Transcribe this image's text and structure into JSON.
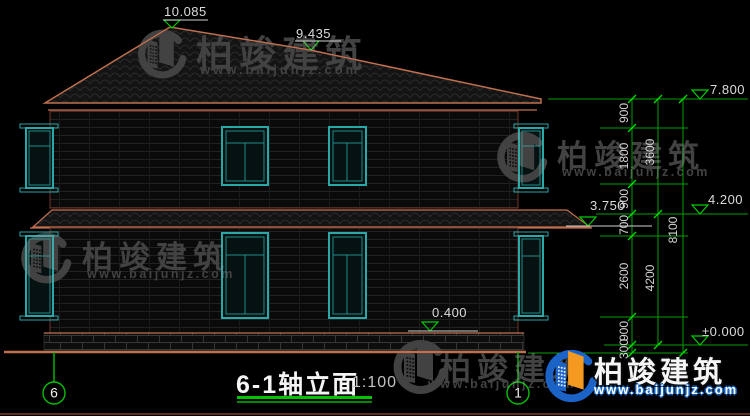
{
  "title_block": {
    "title": "6-1轴立面",
    "scale": "1:100"
  },
  "axes": {
    "left": "6",
    "right": "1"
  },
  "levels": {
    "ridge": "10.085",
    "roof_break": "9.435",
    "eave": "7.800",
    "second_top": "4.200",
    "awning": "3.750",
    "plinth": "0.400",
    "ground": "±0.000"
  },
  "dims": {
    "chain1": [
      "900",
      "1800",
      "900",
      "700",
      "2600",
      "900",
      "300"
    ],
    "chain2": [
      "3600",
      "4200"
    ],
    "chain3": [
      "8100"
    ]
  },
  "watermark": {
    "brand": "柏竣建筑",
    "url": "www.baijunjz.com"
  },
  "colors": {
    "window_teal": "#2aa7a7",
    "dimension_green": "#00b400",
    "roof_outline_salmon": "#c0704f",
    "wall_outline": "#6e352a",
    "watermark_gray": "#424242",
    "logo_blue": "#1c63c8",
    "logo_orange": "#f49a20"
  }
}
